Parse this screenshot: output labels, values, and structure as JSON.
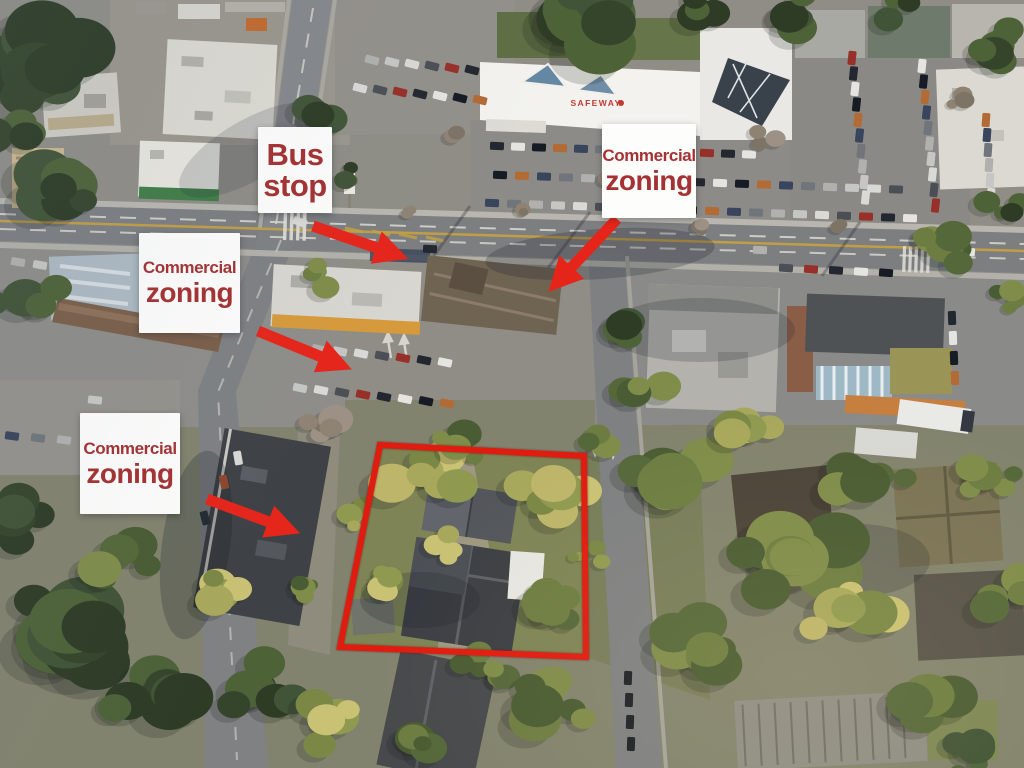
{
  "annotations": {
    "bus_stop": {
      "line1": "Bus",
      "line2": "stop"
    },
    "commercial_zoning": [
      {
        "line1": "Commercial",
        "line2": "zoning"
      },
      {
        "line1": "Commercial",
        "line2": "zoning"
      },
      {
        "line1": "Commercial",
        "line2": "zoning"
      }
    ]
  },
  "signs": {
    "safeway": "SAFEWAY"
  },
  "colors": {
    "annotation_red": "#e6251a",
    "outline_red": "#e01b10",
    "label_text_red": "#a53132",
    "label_bg": "#fdfdfb",
    "safeway_sign_red": "#c23b33"
  }
}
